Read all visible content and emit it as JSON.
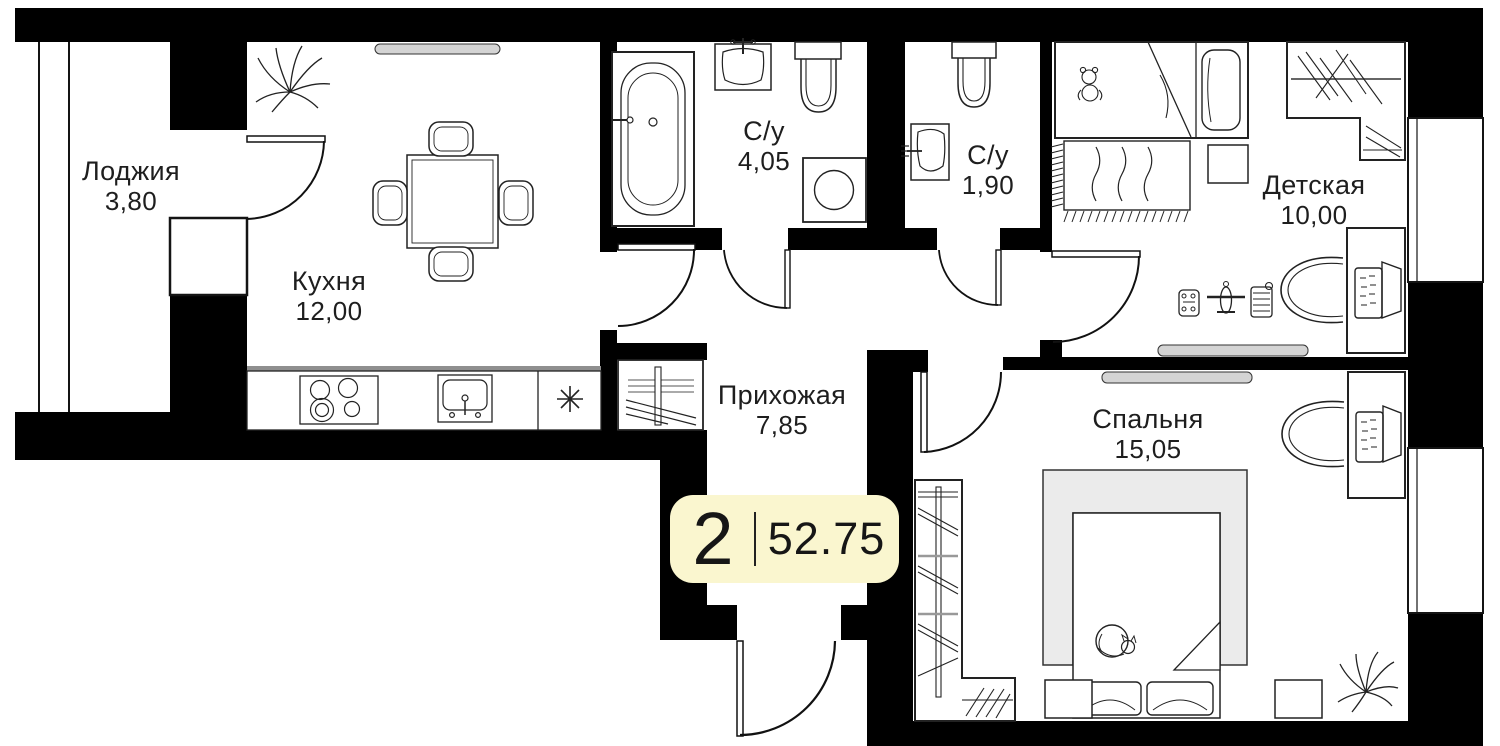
{
  "badge": {
    "rooms_count": "2",
    "total_area": "52.75"
  },
  "rooms": {
    "loggia": {
      "name": "Лоджия",
      "area": "3,80"
    },
    "kitchen": {
      "name": "Кухня",
      "area": "12,00"
    },
    "bathroom_main": {
      "name": "С/у",
      "area": "4,05"
    },
    "bathroom_guest": {
      "name": "С/у",
      "area": "1,90"
    },
    "children": {
      "name": "Детская",
      "area": "10,00"
    },
    "hallway": {
      "name": "Прихожая",
      "area": "7,85"
    },
    "bedroom": {
      "name": "Спальня",
      "area": "15,05"
    }
  },
  "colors": {
    "wall": "#000000",
    "badge_bg": "#faf6cf",
    "shelf_gray": "#d4d4d4",
    "bed_frame_gray": "#ebebeb"
  },
  "icons": {
    "appliance_marker": "asterisk-icon"
  }
}
